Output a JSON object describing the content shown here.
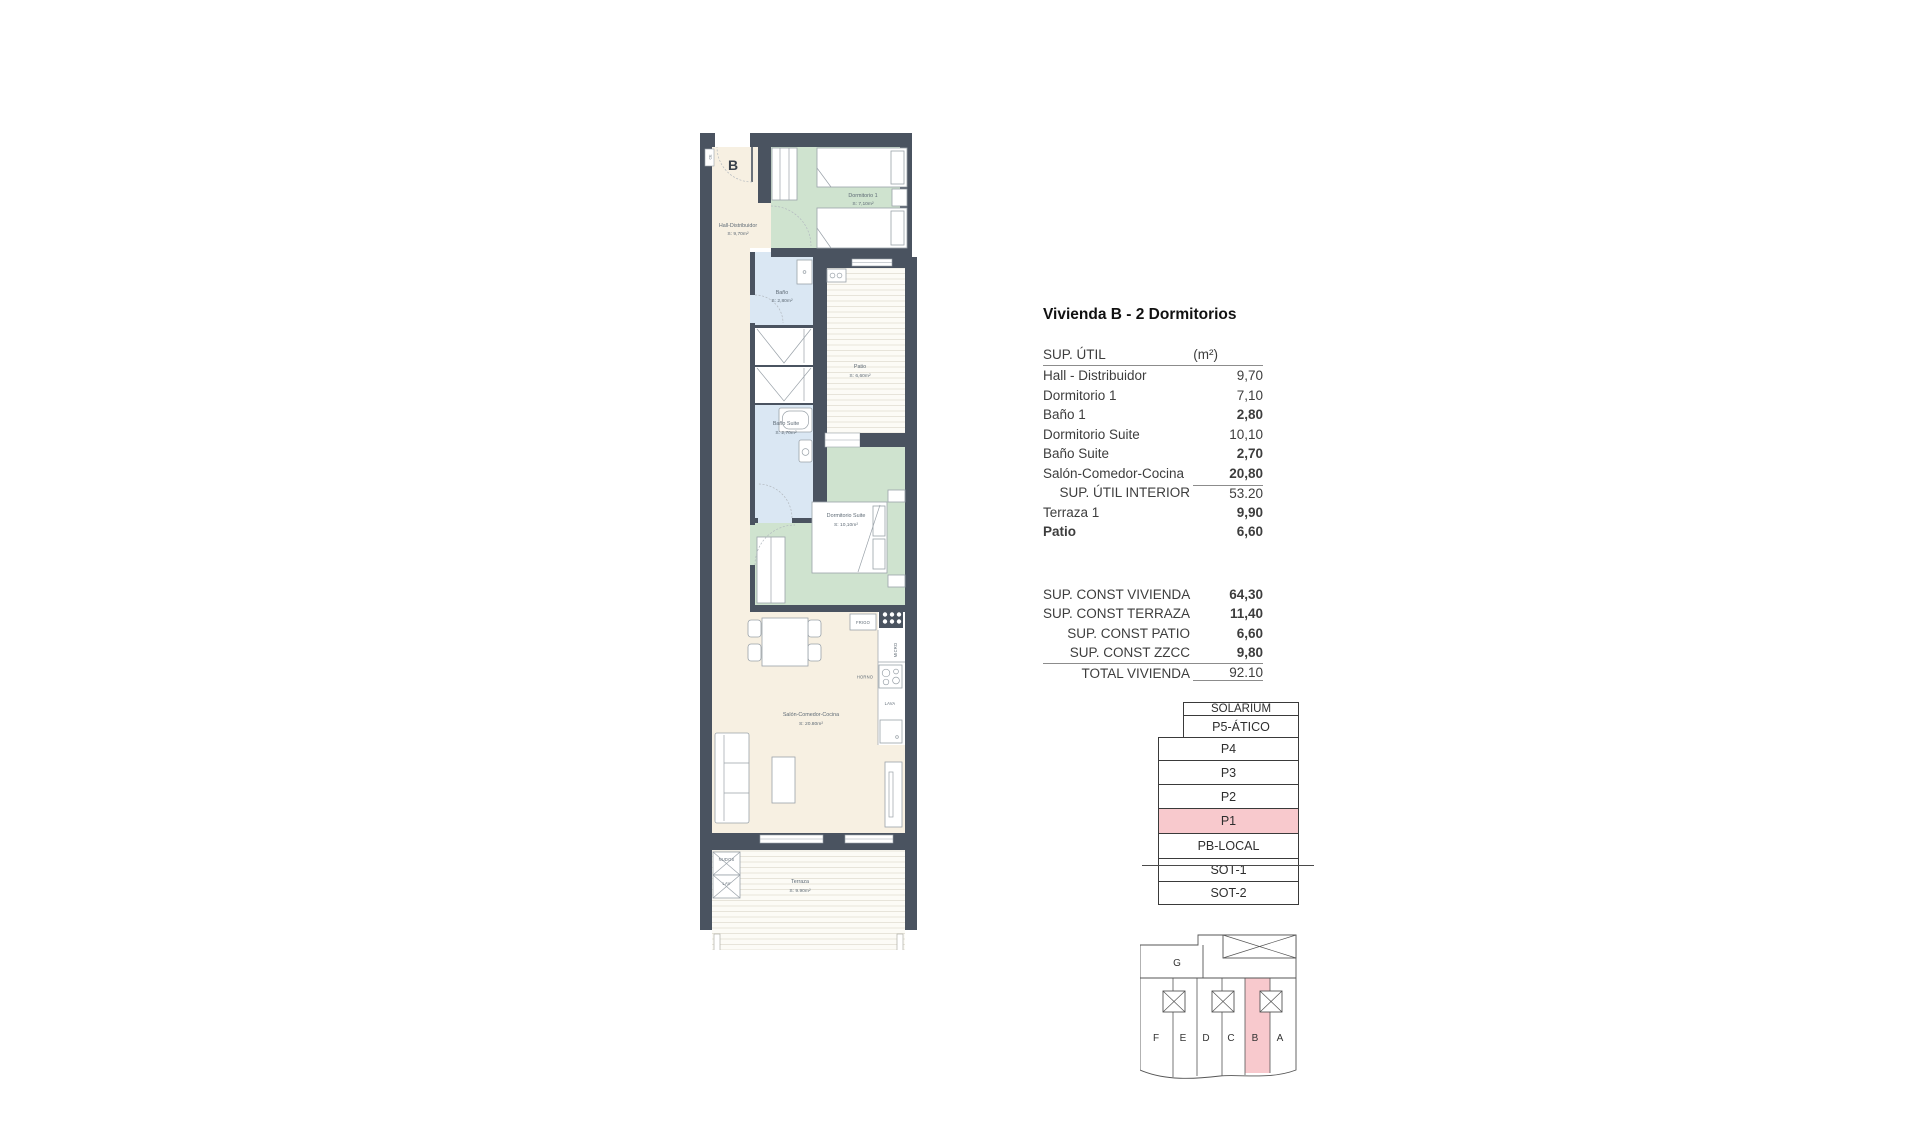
{
  "plan": {
    "unit_letter": "B",
    "rooms": [
      {
        "id": "hall",
        "name": "Hall-Distribuidor",
        "area": "S: 9,70m²"
      },
      {
        "id": "dorm1",
        "name": "Dormitorio 1",
        "area": "S: 7,10m²"
      },
      {
        "id": "bano",
        "name": "Baño",
        "area": "S: 2,80m²"
      },
      {
        "id": "patio",
        "name": "Patio",
        "area": "S: 6,60m²"
      },
      {
        "id": "bano_suite",
        "name": "Baño Suite",
        "area": "S: 2,70m²"
      },
      {
        "id": "dorm_suite",
        "name": "Dormitorio Suite",
        "area": "S: 10,10m²"
      },
      {
        "id": "salon",
        "name": "Salón-Comedor-Cocina",
        "area": "S: 20.80m²"
      },
      {
        "id": "terraza",
        "name": "Terraza",
        "area": "S: 9.90m²"
      }
    ],
    "fixtures": {
      "frigo": "FRIGO",
      "micro": "MICRO",
      "horno": "HORNO",
      "lava": "LAVA",
      "nudos": "NUDOS",
      "lav": "LAV",
      "ce": "CE"
    }
  },
  "panel": {
    "title": "Vivienda B - 2 Dormitorios",
    "sup_util": {
      "header": "SUP. ÚTIL",
      "unit_header": "(m²)",
      "rows": [
        {
          "label": "Hall - Distribuidor",
          "value": "9,70"
        },
        {
          "label": "Dormitorio 1",
          "value": "7,10"
        },
        {
          "label": "Baño 1",
          "value": "2,80"
        },
        {
          "label": "Dormitorio Suite",
          "value": "10,10"
        },
        {
          "label": "Baño Suite",
          "value": "2,70"
        },
        {
          "label": "Salón-Comedor-Cocina",
          "value": "20,80"
        },
        {
          "label": "SUP. ÚTIL INTERIOR",
          "value": "53.20"
        },
        {
          "label": "Terraza 1",
          "value": "9,90"
        },
        {
          "label": "Patio",
          "value": "6,60"
        }
      ]
    },
    "sup_const": {
      "rows": [
        {
          "label": "SUP. CONST VIVIENDA",
          "value": "64,30"
        },
        {
          "label": "SUP. CONST TERRAZA",
          "value": "11,40"
        },
        {
          "label": "SUP. CONST PATIO",
          "value": "6,60"
        },
        {
          "label": "SUP. CONST ZZCC",
          "value": "9,80"
        },
        {
          "label": "TOTAL VIVIENDA",
          "value": "92.10"
        }
      ]
    }
  },
  "stack": {
    "floors": [
      {
        "label": "SOLARIUM"
      },
      {
        "label": "P5-ÁTICO"
      },
      {
        "label": "P4"
      },
      {
        "label": "P3"
      },
      {
        "label": "P2"
      },
      {
        "label": "P1",
        "highlight": true
      },
      {
        "label": "PB-LOCAL"
      },
      {
        "label": "SOT-1"
      },
      {
        "label": "SOT-2"
      }
    ]
  },
  "building": {
    "top_label": "G",
    "units": [
      "F",
      "E",
      "D",
      "C",
      "B",
      "A"
    ],
    "highlighted_unit": "B"
  },
  "colors": {
    "wall": "#4a5360",
    "hall_floor": "#f7f0e2",
    "bedroom_green": "#cfe3cf",
    "bath_blue": "#dae7f3",
    "highlight_pink": "#f8c9cd"
  }
}
